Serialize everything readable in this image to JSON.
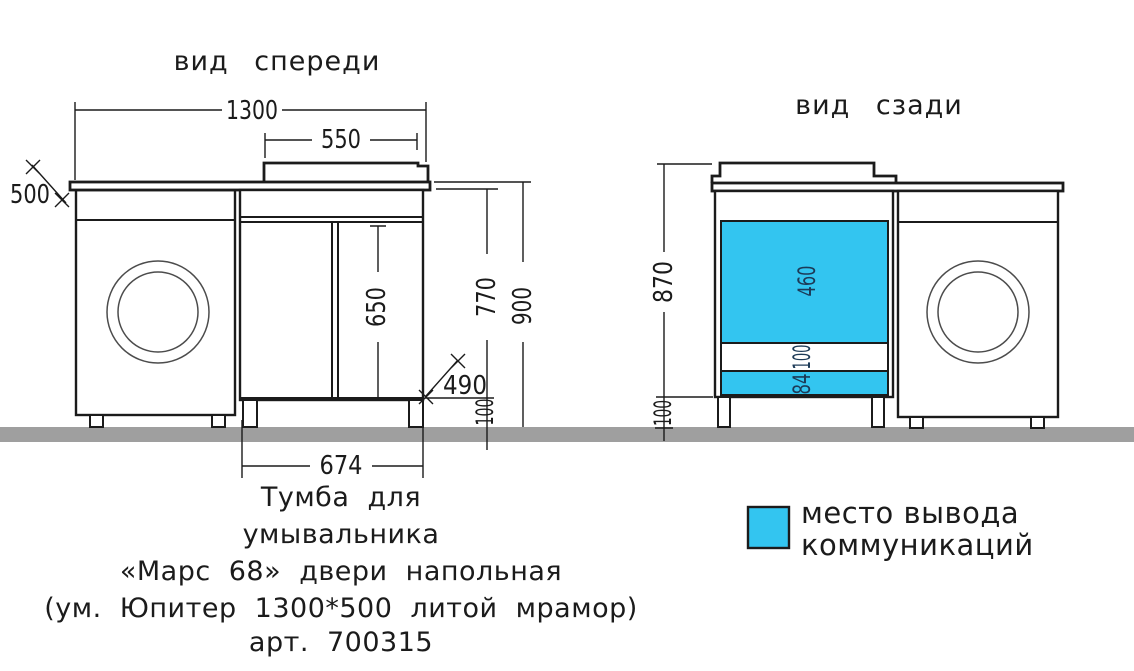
{
  "drawing": {
    "front_view": {
      "title": "вид спереди",
      "dims": {
        "total_width": "1300",
        "sink_width": "550",
        "depth": "500",
        "door_height": "650",
        "cabinet_height": "770",
        "total_height": "900",
        "corner_detail": "490",
        "leg_height": "100",
        "cabinet_width": "674"
      }
    },
    "back_view": {
      "title": "вид сзади",
      "dims": {
        "body_height": "870",
        "leg_height": "100",
        "panel_height": "460",
        "gap_height": "100",
        "strip_height": "84"
      }
    },
    "legend": {
      "line1": "место вывода",
      "line2": "коммуникаций"
    },
    "caption": {
      "line1": "Тумба для",
      "line2": "умывальника",
      "line3": "«Марс 68» двери напольная",
      "line4": "(ум. Юпитер 1300*500 литой мрамор)",
      "line5": "арт. 700315"
    },
    "colors": {
      "line": "#1b1b1b",
      "highlight": "#33c5f0",
      "floor": "#9f9f9f",
      "drum": "#4c4c4c",
      "label_on_highlight": "#1c3a57",
      "background": "#ffffff"
    }
  }
}
